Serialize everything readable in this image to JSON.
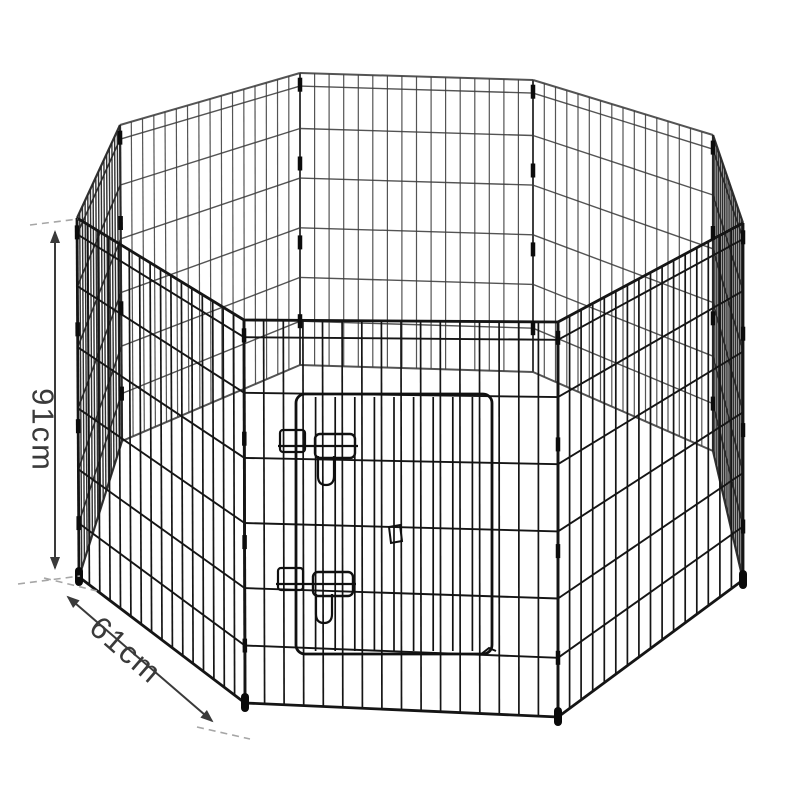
{
  "image": {
    "width": 800,
    "height": 800,
    "background": "#ffffff",
    "alt": "Black wire 8-panel octagonal pet playpen with front door and dimension arrows"
  },
  "annotations": {
    "height": {
      "label": "91cm",
      "arrow": {
        "x1": 55,
        "y1": 232,
        "x2": 55,
        "y2": 568
      },
      "leaders": [
        [
          30,
          225,
          78,
          219
        ],
        [
          18,
          584,
          80,
          576
        ]
      ],
      "label_pos": {
        "x": 43,
        "y": 430,
        "rotate": 90
      }
    },
    "width": {
      "label": "61cm",
      "arrow": {
        "x1": 68,
        "y1": 597,
        "x2": 212,
        "y2": 721
      },
      "leaders": [
        [
          44,
          578,
          97,
          591
        ],
        [
          197,
          727,
          250,
          739
        ]
      ],
      "label_pos": {
        "x": 126,
        "y": 650,
        "rotate": 41
      }
    },
    "style": {
      "arrow_color": "#3a3a3a",
      "leader_color": "#a6a6a6",
      "text_color": "#3a3a3a",
      "font_size": 31
    }
  },
  "scene": {
    "posts": {
      "A": {
        "top": [
          77,
          218
        ],
        "bot": [
          79,
          577
        ]
      },
      "B": {
        "top": [
          120,
          125
        ],
        "bot": [
          122,
          441
        ]
      },
      "C": {
        "top": [
          300,
          73
        ],
        "bot": [
          300,
          365
        ]
      },
      "D": {
        "top": [
          533,
          80
        ],
        "bot": [
          533,
          372
        ]
      },
      "G": {
        "top": [
          713,
          135
        ],
        "bot": [
          713,
          451
        ]
      },
      "H": {
        "top": [
          743,
          223
        ],
        "bot": [
          743,
          580
        ]
      },
      "FL": {
        "top": [
          244,
          320
        ],
        "bot": [
          245,
          703
        ]
      },
      "FR": {
        "top": [
          558,
          322
        ],
        "bot": [
          558,
          717
        ]
      }
    },
    "panels": [
      {
        "name": "back-center",
        "left": "C",
        "right": "D",
        "group": "far"
      },
      {
        "name": "back-left",
        "left": "B",
        "right": "C",
        "group": "far"
      },
      {
        "name": "back-right",
        "left": "D",
        "right": "G",
        "group": "far"
      },
      {
        "name": "left-side",
        "left": "A",
        "right": "B",
        "group": "side"
      },
      {
        "name": "right-side",
        "left": "G",
        "right": "H",
        "group": "side"
      },
      {
        "name": "front-left",
        "left": "A",
        "right": "FL",
        "group": "near"
      },
      {
        "name": "front-right",
        "left": "FR",
        "right": "H",
        "group": "near"
      },
      {
        "name": "front-door-panel",
        "left": "FL",
        "right": "FR",
        "group": "near"
      }
    ],
    "groups": {
      "far": {
        "color": "#3c3c3c",
        "wire": 1.2,
        "rail": 1.4,
        "frame": 2.0,
        "opacity": 0.88
      },
      "side": {
        "color": "#262626",
        "wire": 1.4,
        "rail": 1.6,
        "frame": 2.2,
        "opacity": 0.95
      },
      "near": {
        "color": "#151515",
        "wire": 1.7,
        "rail": 1.9,
        "frame": 2.8,
        "opacity": 1
      }
    },
    "verticals_per_panel": 15,
    "rail_fractions": [
      0.045,
      0.19,
      0.36,
      0.53,
      0.7,
      0.85
    ],
    "door": {
      "x": 296,
      "y": 394,
      "w": 196,
      "h": 260,
      "rx": 9,
      "verticals": 9,
      "frame": 2.8,
      "color": "#101010"
    },
    "latches": [
      {
        "x": 278,
        "y": 430
      },
      {
        "x": 276,
        "y": 568
      }
    ],
    "latch_color": "#101010",
    "door_clips": [
      "M389,527 l11,-2 l2,16 l-11,2 z",
      "M480,655 l9,-7 l7,3"
    ],
    "clip_posts": [
      "A",
      "H",
      "FL",
      "FR",
      "B",
      "G",
      "C",
      "D"
    ],
    "clip_fracs": [
      0.04,
      0.31,
      0.58,
      0.85
    ],
    "clip_color": "#0c0c0c",
    "feet_posts": [
      "A",
      "H",
      "FL",
      "FR"
    ],
    "feet_color": "#0a0a0a"
  }
}
